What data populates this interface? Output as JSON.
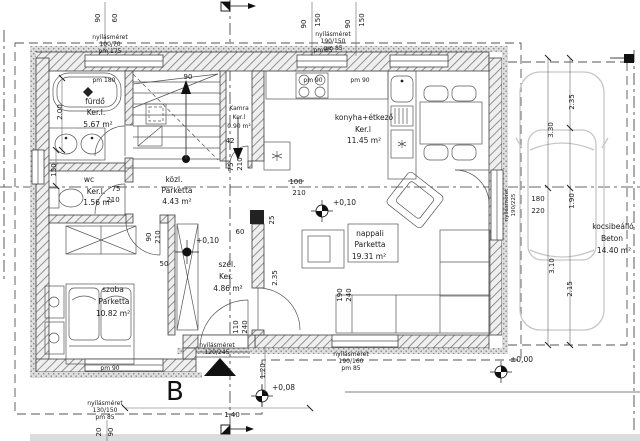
{
  "rooms": {
    "furdo": {
      "name": "fürdő",
      "finish": "Ker.l.",
      "area": "5.67 m²"
    },
    "kamra": {
      "name": "Kamra",
      "finish": "Ker.l",
      "area": "0.90 m²"
    },
    "wc": {
      "name": "wc",
      "finish": "Ker.l.",
      "area": "1.56 m²"
    },
    "kozl": {
      "name": "közl.",
      "finish": "Parketta",
      "area": "4.43 m²"
    },
    "szoba": {
      "name": "szoba",
      "finish": "Parketta",
      "area": "10.82 m²"
    },
    "szel": {
      "name": "szél.",
      "finish": "Ker.",
      "area": "4.86 m²"
    },
    "konyha": {
      "name": "konyha+étkező",
      "finish": "Ker.l",
      "area": "11.45 m²"
    },
    "nappali": {
      "name": "nappali",
      "finish": "Parketta",
      "area": "19.31 m²"
    },
    "kocsibeallo": {
      "name": "kocsibeálló",
      "finish": "Beton",
      "area": "14.40 m²"
    }
  },
  "levels": {
    "living": "+0,10",
    "hall": "+0,10",
    "terrace": "±0,00",
    "entry": "+0,08"
  },
  "openings": {
    "top_left": [
      "nyílásméret",
      "100/70",
      "pm 175"
    ],
    "top_right": [
      "nyílásméret",
      "190/150",
      "pm 85"
    ],
    "bottom_left": [
      "nyílásméret",
      "130/150",
      "pm 85"
    ],
    "bottom_right": [
      "nyílásméret",
      "190/160",
      "pm 85"
    ],
    "entrance": [
      "nyílásméret",
      "120/245"
    ],
    "right_door": [
      "nyílásméret",
      "190/225"
    ]
  },
  "parapets": {
    "bath": "pm 180",
    "kitchen_window": "pm 85",
    "kitchen_left": "pm 90",
    "kitchen_right": "pm 90",
    "bedroom": "pm 90"
  },
  "markers": {
    "section": "B"
  },
  "dims": [
    {
      "t": "90",
      "x": 100,
      "y": 18,
      "r": -90
    },
    {
      "t": "60",
      "x": 117,
      "y": 18,
      "r": -90
    },
    {
      "t": "90",
      "x": 306,
      "y": 24,
      "r": -90
    },
    {
      "t": "150",
      "x": 320,
      "y": 20,
      "r": -90
    },
    {
      "t": "90",
      "x": 350,
      "y": 24,
      "r": -90
    },
    {
      "t": "150",
      "x": 364,
      "y": 20,
      "r": -90
    },
    {
      "t": "2.00",
      "x": 62,
      "y": 112,
      "r": -90
    },
    {
      "t": "150",
      "x": 56,
      "y": 170,
      "r": -90
    },
    {
      "t": "90",
      "x": 188,
      "y": 79,
      "r": 0
    },
    {
      "t": "42",
      "x": 230,
      "y": 143,
      "r": 0
    },
    {
      "t": "75",
      "x": 233,
      "y": 167,
      "r": -90
    },
    {
      "t": "210",
      "x": 242,
      "y": 164,
      "r": -90
    },
    {
      "t": "75",
      "x": 116,
      "y": 191,
      "r": 0
    },
    {
      "t": "210",
      "x": 113,
      "y": 202,
      "r": 0
    },
    {
      "t": "100",
      "x": 296,
      "y": 184,
      "r": 0
    },
    {
      "t": "210",
      "x": 299,
      "y": 195,
      "r": 0
    },
    {
      "t": "90",
      "x": 151,
      "y": 237,
      "r": -90
    },
    {
      "t": "210",
      "x": 160,
      "y": 237,
      "r": -90
    },
    {
      "t": "50",
      "x": 164,
      "y": 266,
      "r": 0
    },
    {
      "t": "60",
      "x": 240,
      "y": 234,
      "r": 0
    },
    {
      "t": "25",
      "x": 274,
      "y": 220,
      "r": -90
    },
    {
      "t": "2.35",
      "x": 277,
      "y": 278,
      "r": -90
    },
    {
      "t": "110",
      "x": 238,
      "y": 327,
      "r": -90
    },
    {
      "t": "240",
      "x": 247,
      "y": 327,
      "r": -90
    },
    {
      "t": "190",
      "x": 342,
      "y": 295,
      "r": -90
    },
    {
      "t": "240",
      "x": 351,
      "y": 295,
      "r": -90
    },
    {
      "t": "1.20",
      "x": 265,
      "y": 371,
      "r": -90
    },
    {
      "t": "1.40",
      "x": 232,
      "y": 417,
      "r": 0
    },
    {
      "t": "20",
      "x": 101,
      "y": 432,
      "r": -90
    },
    {
      "t": "90",
      "x": 113,
      "y": 432,
      "r": -90
    },
    {
      "t": "2.35",
      "x": 574,
      "y": 102,
      "r": -90
    },
    {
      "t": "3.30",
      "x": 553,
      "y": 130,
      "r": -90
    },
    {
      "t": "1.90",
      "x": 574,
      "y": 201,
      "r": -90
    },
    {
      "t": "180",
      "x": 538,
      "y": 201,
      "r": 0
    },
    {
      "t": "220",
      "x": 538,
      "y": 213,
      "r": 0
    },
    {
      "t": "3.10",
      "x": 554,
      "y": 266,
      "r": -90
    },
    {
      "t": "2.15",
      "x": 572,
      "y": 289,
      "r": -90
    }
  ]
}
